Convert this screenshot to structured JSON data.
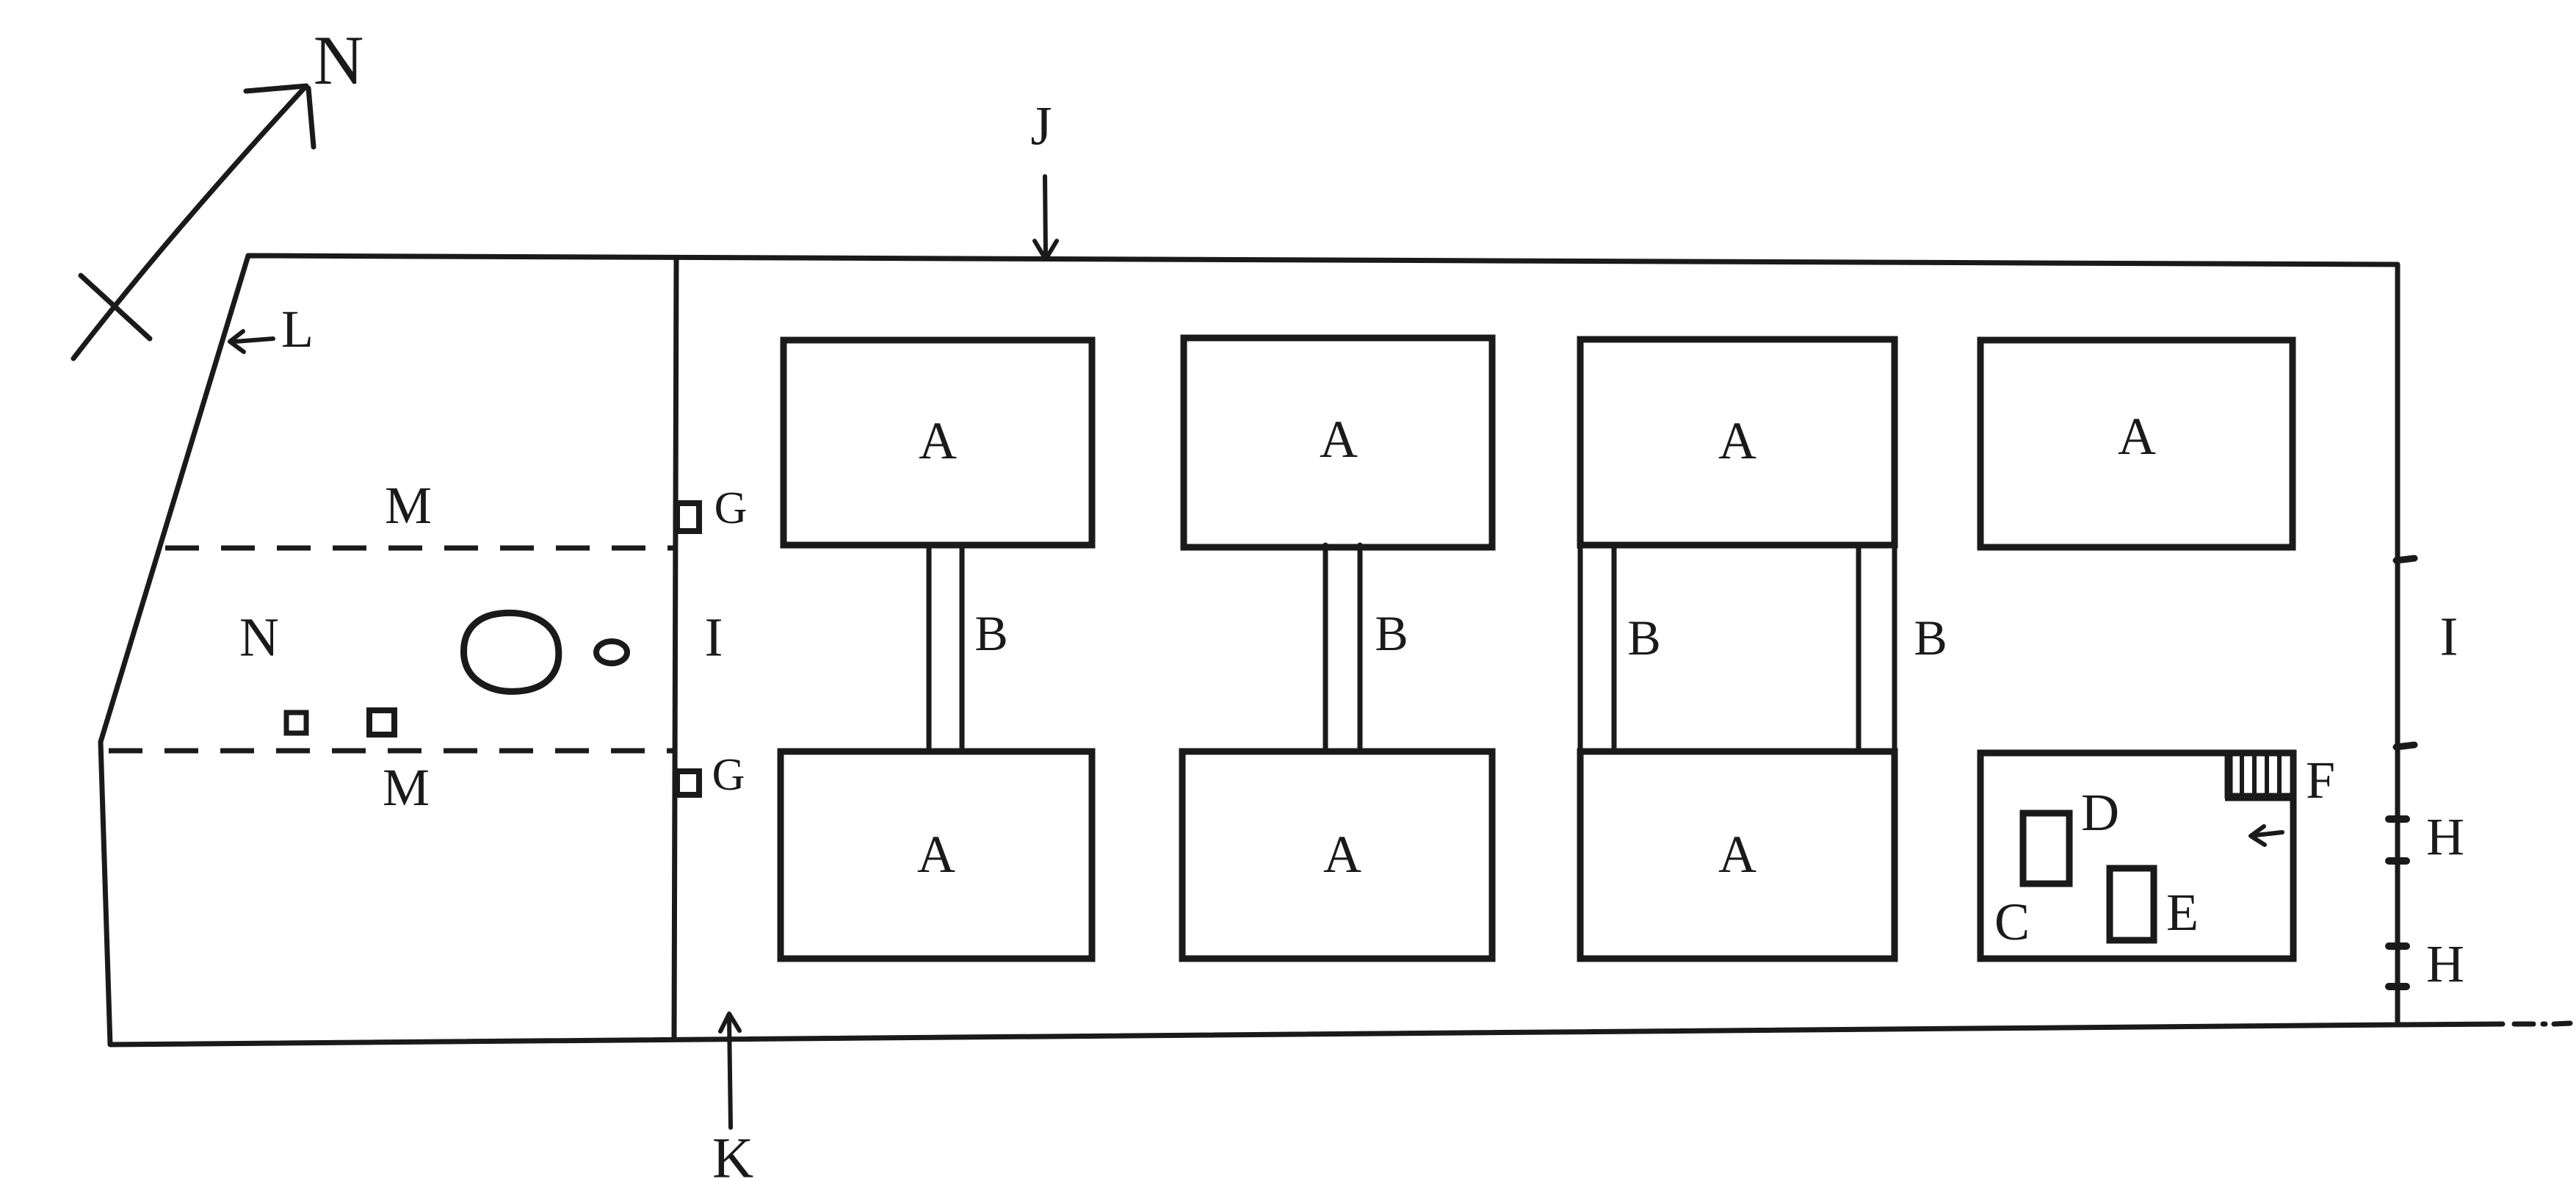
{
  "palette": {
    "ink": "#1a1a1a",
    "paper": "#ffffff"
  },
  "compass": {
    "north": "N"
  },
  "callouts": {
    "top_edge": "J",
    "bottom_edge": "K",
    "west_edge": "L"
  },
  "left_parcel": {
    "area_label": "N",
    "upper_dashed_label": "M",
    "lower_dashed_label": "M"
  },
  "gates": {
    "upper": "G",
    "lower": "G"
  },
  "middle_band": {
    "west": "I",
    "east": "I"
  },
  "halls": {
    "labels": [
      "A",
      "A",
      "A",
      "A",
      "A",
      "A",
      "A"
    ]
  },
  "corridors": {
    "labels": [
      "B",
      "B",
      "B",
      "B"
    ]
  },
  "annex_room": {
    "area": "C",
    "feature_d": "D",
    "feature_e": "E",
    "stairs": "F"
  },
  "east_edge": {
    "upper": "H",
    "lower": "H"
  }
}
